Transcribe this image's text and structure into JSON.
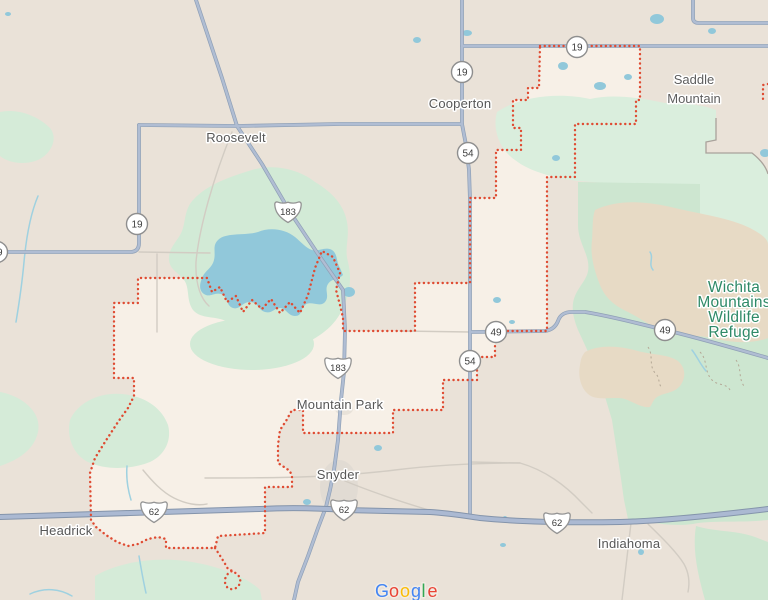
{
  "towns": [
    {
      "name": "Roosevelt"
    },
    {
      "name": "Cooperton"
    },
    {
      "name": "Mountain Park"
    },
    {
      "name": "Snyder"
    },
    {
      "name": "Headrick"
    },
    {
      "name": "Indiahoma"
    }
  ],
  "area_labels": {
    "saddle_mountain": {
      "line1": "Saddle",
      "line2": "Mountain"
    },
    "refuge": {
      "line1": "Wichita",
      "line2": "Mountains",
      "line3": "Wildlife",
      "line4": "Refuge",
      "text_color": "#2F8A68"
    }
  },
  "shields": {
    "circle": [
      {
        "number": "19"
      },
      {
        "number": "19"
      },
      {
        "number": "19"
      },
      {
        "number": "19"
      },
      {
        "number": "54"
      },
      {
        "number": "54"
      },
      {
        "number": "49"
      },
      {
        "number": "49"
      }
    ],
    "us": [
      {
        "number": "183"
      },
      {
        "number": "183"
      },
      {
        "number": "62"
      },
      {
        "number": "62"
      },
      {
        "number": "62"
      }
    ]
  },
  "boundary": {
    "color": "#DF4B32",
    "style": "dotted"
  },
  "water_color": "#91C8DA",
  "attribution": {
    "brand": "Google",
    "letters": [
      {
        "ch": "G",
        "color": "#4285F4"
      },
      {
        "ch": "o",
        "color": "#EA4335"
      },
      {
        "ch": "o",
        "color": "#FBBC05"
      },
      {
        "ch": "g",
        "color": "#4285F4"
      },
      {
        "ch": "l",
        "color": "#34A853"
      },
      {
        "ch": "e",
        "color": "#EA4335"
      }
    ]
  }
}
